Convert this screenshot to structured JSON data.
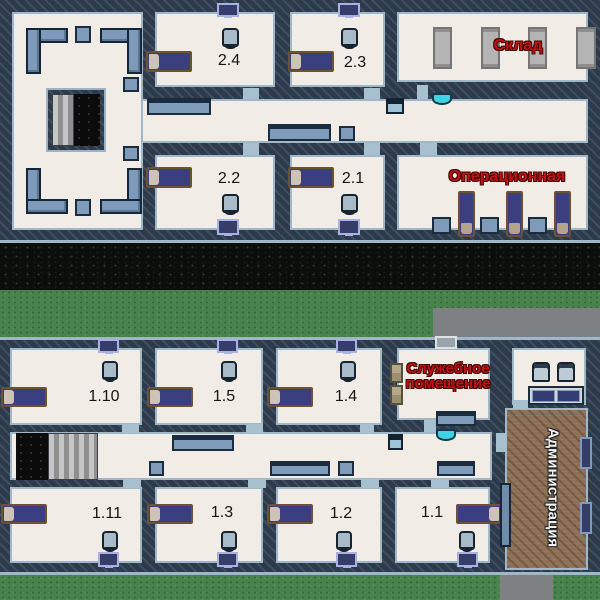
{
  "map": {
    "title": "Hospital floor map",
    "floors": {
      "upper": {
        "rooms": {
          "r24": {
            "label": "2.4"
          },
          "r23": {
            "label": "2.3"
          },
          "r22": {
            "label": "2.2"
          },
          "r21": {
            "label": "2.1"
          },
          "sklad": {
            "label": "Склад"
          },
          "oper": {
            "label": "Операционная"
          }
        }
      },
      "lower": {
        "rooms": {
          "r110": {
            "label": "1.10"
          },
          "r15": {
            "label": "1.5"
          },
          "r14": {
            "label": "1.4"
          },
          "sluzh": {
            "label": "Служебное помещение"
          },
          "r111": {
            "label": "1.11"
          },
          "r13": {
            "label": "1.3"
          },
          "r12": {
            "label": "1.2"
          },
          "r11": {
            "label": "1.1"
          },
          "admin": {
            "label": "Администрация"
          }
        }
      }
    },
    "colors": {
      "wall": "#2c3a4b",
      "wall_edge": "#a0b7c7",
      "floor": "#f1ece5",
      "wood_floor": "#8d7156",
      "furniture_steel": "#7e9cba",
      "bed_blanket": "#3b3e7f",
      "bed_frame": "#6d5130",
      "label_red": "#c01212",
      "label_white": "#f2f2f2",
      "label_black": "#141414",
      "grass": "#47834b",
      "asphalt": "#0c0e0c",
      "concrete": "#7e8184",
      "sink_cyan": "#3ed4e6"
    }
  }
}
